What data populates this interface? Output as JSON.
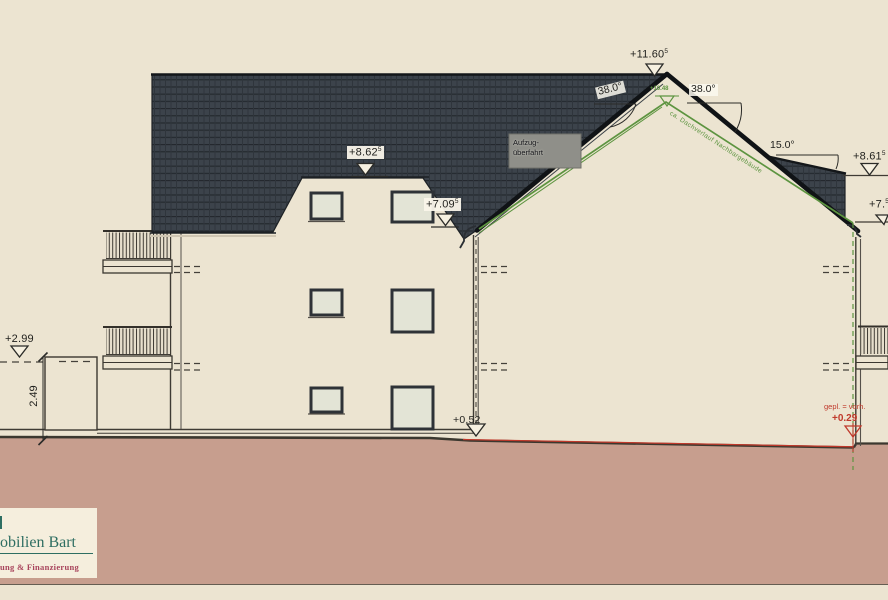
{
  "colors": {
    "background": "#ece4d1",
    "roof_tile": "#3c434b",
    "ground_fill": "#c79e8e",
    "neighbor_outline_green": "#5d9440",
    "planned_red": "#c0392b",
    "logo_green": "#2e6e62",
    "logo_red": "#a8445c"
  },
  "levels": {
    "ridge": {
      "value": "+11.60",
      "sup": "5"
    },
    "upper_roof": {
      "value": "+8.62",
      "sup": "5"
    },
    "eaves_left_building": {
      "value": "+7.09",
      "sup": "5"
    },
    "neighbor_eaves": {
      "value": "+8.61",
      "sup": "5"
    },
    "right_edge": {
      "value": "+7.",
      "sup": "5"
    },
    "neighbor_ridge": {
      "value": "+10.48"
    },
    "terrain_left": {
      "value": "+2.99"
    },
    "terrain_building": {
      "value": "+0.52"
    },
    "terrain_planned": {
      "value": "+0.29"
    }
  },
  "angles": {
    "left_roof": "38.0°",
    "right_roof": "38.0°",
    "lower_roof": "15.0°"
  },
  "labels": {
    "elevator_line1": "Aufzug-",
    "elevator_line2": "überfahrt",
    "neighbor_roof_note": "ca. Dachverlauf Nachbargebäude",
    "planned_note": "gepl. = vorh.",
    "wall_height_dim": "2.49"
  },
  "logo": {
    "name": "obilien Bart",
    "tagline": "ung & Finanzierung"
  }
}
